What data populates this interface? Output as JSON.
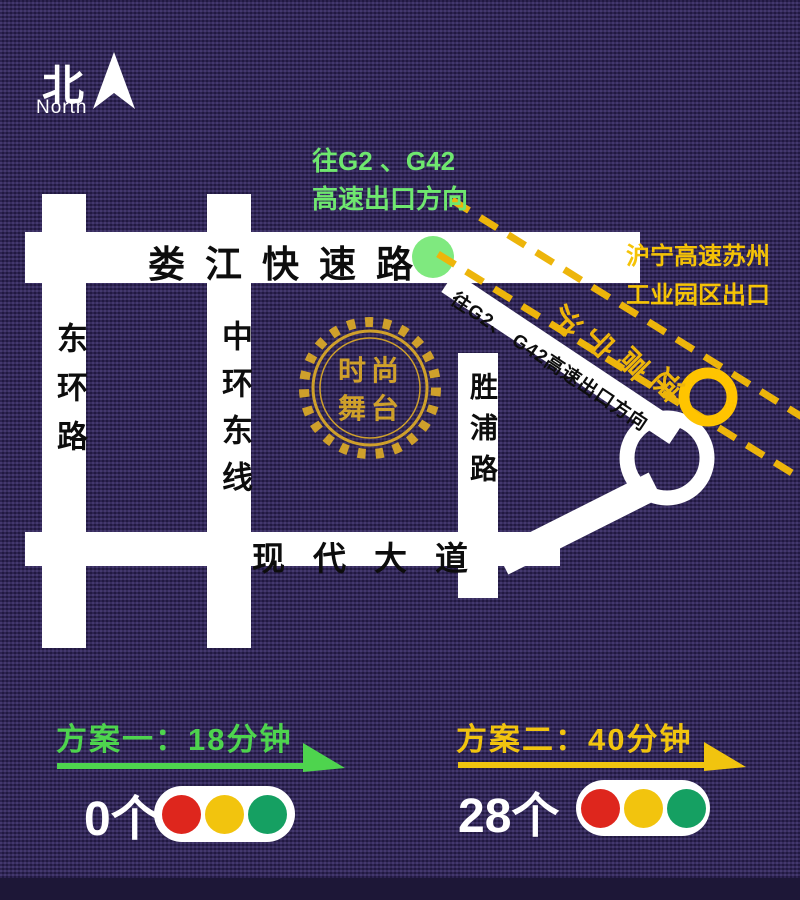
{
  "compass": {
    "label_cn": "北",
    "label_en": "North",
    "arrow_icon": "north-arrow"
  },
  "hints": {
    "g2_exit_line1": "往G2 、G42",
    "g2_exit_line2": "高速出口方向",
    "huning_exit_line1": "沪宁高速苏州",
    "huning_exit_line2": "工业园区出口",
    "huning_highway": "沪宁高速",
    "ramp_label": "往G2、 G42高速出口方向"
  },
  "roads": {
    "loujiang_expressway": "娄江快速路",
    "east_ring_road": "东环路",
    "middle_ring_east_line": "中环东线",
    "shengpu_road": "胜浦路",
    "modern_avenue": "现代大道"
  },
  "logo": {
    "line1": "时尚",
    "line2": "舞台"
  },
  "plans": {
    "plan1": {
      "title": "方案一：18分钟",
      "count": "0个",
      "color": "#4ed44e"
    },
    "plan2": {
      "title": "方案二：40分钟",
      "count": "28个",
      "color": "#f1c40f"
    }
  },
  "colors": {
    "background": "#2b2150",
    "road_white": "#ffffff",
    "hint_green": "#6fe76f",
    "plan_green": "#4ed44e",
    "highway_yellow": "#edb50b",
    "label_yellow": "#f5c306",
    "ring_yellow": "#ffc400",
    "green_dot": "#7fe97f",
    "logo_gold": "#cfa02b",
    "traffic_red": "#de261d",
    "traffic_yellow": "#f2c40e",
    "traffic_green": "#15a062"
  }
}
